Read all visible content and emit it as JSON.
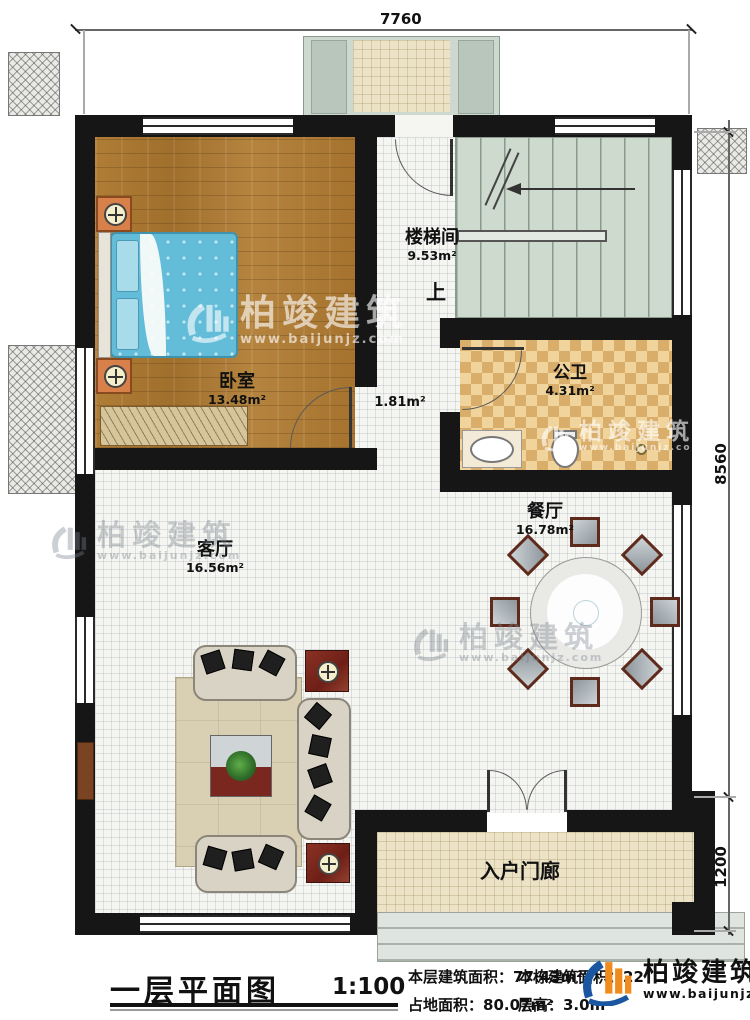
{
  "dims": {
    "top": "7760",
    "right_upper": "8560",
    "right_lower": "1200"
  },
  "rooms": {
    "stairwell": {
      "name": "楼梯间",
      "area": "9.53m²"
    },
    "bedroom": {
      "name": "卧室",
      "area": "13.48m²"
    },
    "bathroom": {
      "name": "公卫",
      "area": "4.31m²"
    },
    "hallway": {
      "area": "1.81m²"
    },
    "dining": {
      "name": "餐厅",
      "area": "16.78m²"
    },
    "living": {
      "name": "客厅",
      "area": "16.56m²"
    },
    "porch": {
      "name": "入户门廊"
    }
  },
  "labels": {
    "up": "上"
  },
  "titleblock": {
    "title": "一层平面图",
    "scale": "1:100",
    "floor_area": "本层建筑面积：77.43m²",
    "land_area": "占地面积：80.07m²",
    "total_area": "本栋建筑面积：22",
    "floor_height": "层高：3.0m"
  },
  "brand": {
    "name": "柏竣建筑",
    "url": "www.baijunjz.com"
  },
  "colors": {
    "wall": "#161616",
    "logo_blue": "#1a57a0",
    "logo_orange": "#f08c1e"
  }
}
